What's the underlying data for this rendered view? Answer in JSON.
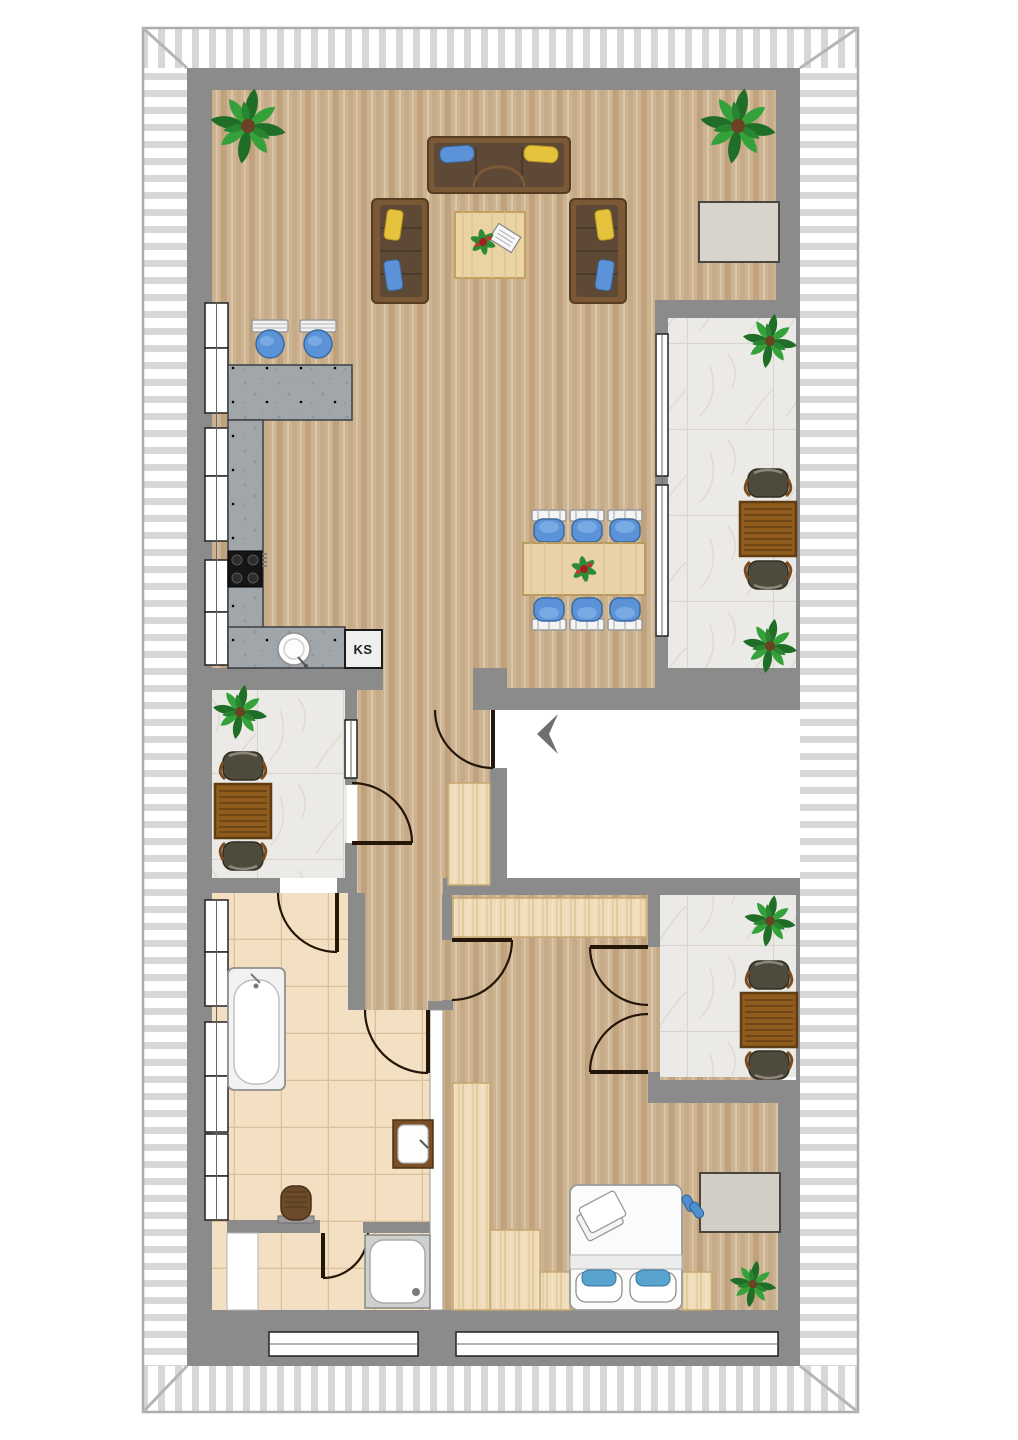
{
  "title": "attic-apartment-floor-plan",
  "labels": {
    "fridge": "KS"
  },
  "entrance": {
    "marker": "arrow-left"
  },
  "colors": {
    "wall": "#8b8b8b",
    "wood_floor": "#cdb392",
    "tile_floor": "#f3dfc1",
    "marble_floor": "#eceae6",
    "counter_stone": "#a1a6aa",
    "accent_blue": "#5c93d8",
    "accent_yellow": "#e6c33c",
    "plant_green": "#2f8b33",
    "roof_hatch_stripe": "#d7d7d7",
    "door_line": "#241709"
  },
  "rooms": [
    "living-room",
    "kitchen",
    "dining-area",
    "hallway",
    "stairwell-landing",
    "bathroom",
    "shower-wc",
    "bedroom",
    "balcony-top-right",
    "loggia-left",
    "balcony-bottom-right"
  ],
  "furniture": [
    "three-seat-sofa",
    "loveseat-left",
    "loveseat-right",
    "coffee-table",
    "sideboard-living",
    "bar-stools",
    "kitchen-counter",
    "stove",
    "kitchen-sink",
    "fridge-KS",
    "dining-table",
    "dining-chairs-6",
    "outdoor-table-x3",
    "outdoor-chairs-x6",
    "potted-plants-x7",
    "bathtub",
    "washbasin",
    "toilet",
    "shower-tray",
    "double-bed",
    "nightstands",
    "wardrobes",
    "sideboard-bedroom",
    "slippers"
  ]
}
